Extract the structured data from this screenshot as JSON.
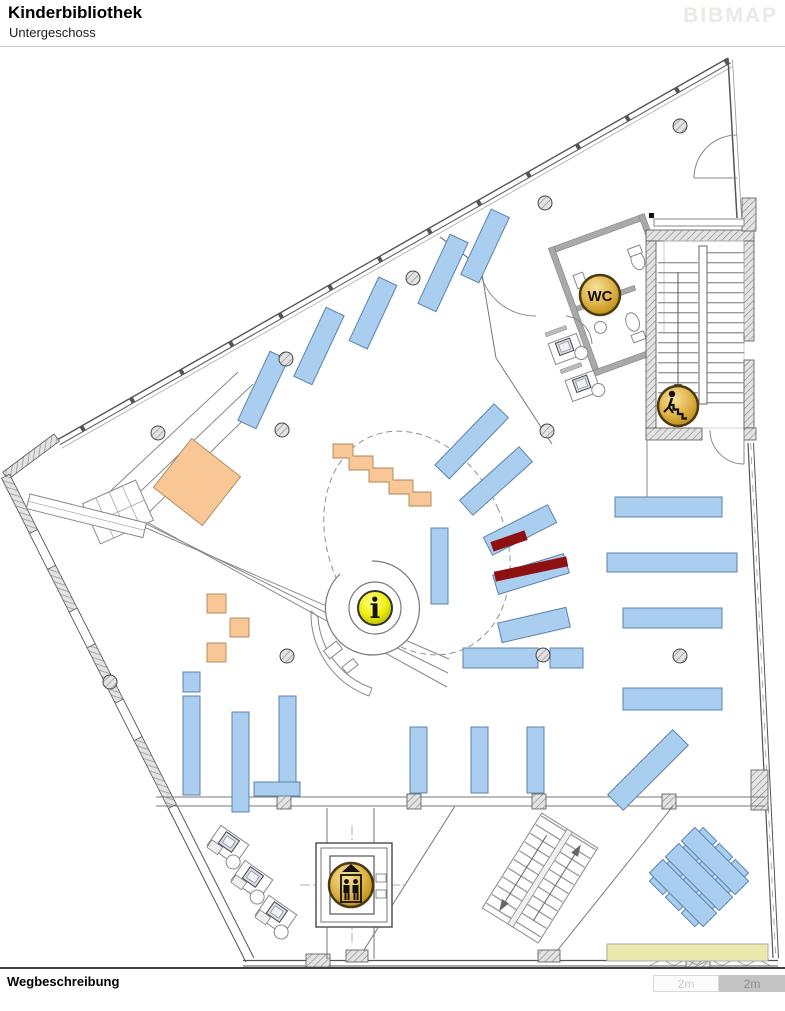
{
  "header": {
    "title": "Kinderbibliothek",
    "subtitle": "Untergeschoss",
    "brand": "BIBMAP"
  },
  "footer": {
    "label": "Wegbeschreibung"
  },
  "scalebar": {
    "left_label": "2m",
    "right_label": "2m"
  },
  "map": {
    "icons": {
      "wc_label": "WC",
      "info_label": "i",
      "stairs": "stairs-down-icon",
      "elevator": "elevator-icon"
    }
  },
  "colors": {
    "shelf": "#aaceef",
    "shelf_border": "#5b82ad",
    "orange": "#f9c795",
    "orange_border": "#a8855a",
    "darkred": "#8e1111",
    "bench": "#ece7ac",
    "gold": "#d9a733",
    "info_yellow": "#e9e920",
    "wall": "#555555",
    "brand": "#e9e9e6"
  }
}
